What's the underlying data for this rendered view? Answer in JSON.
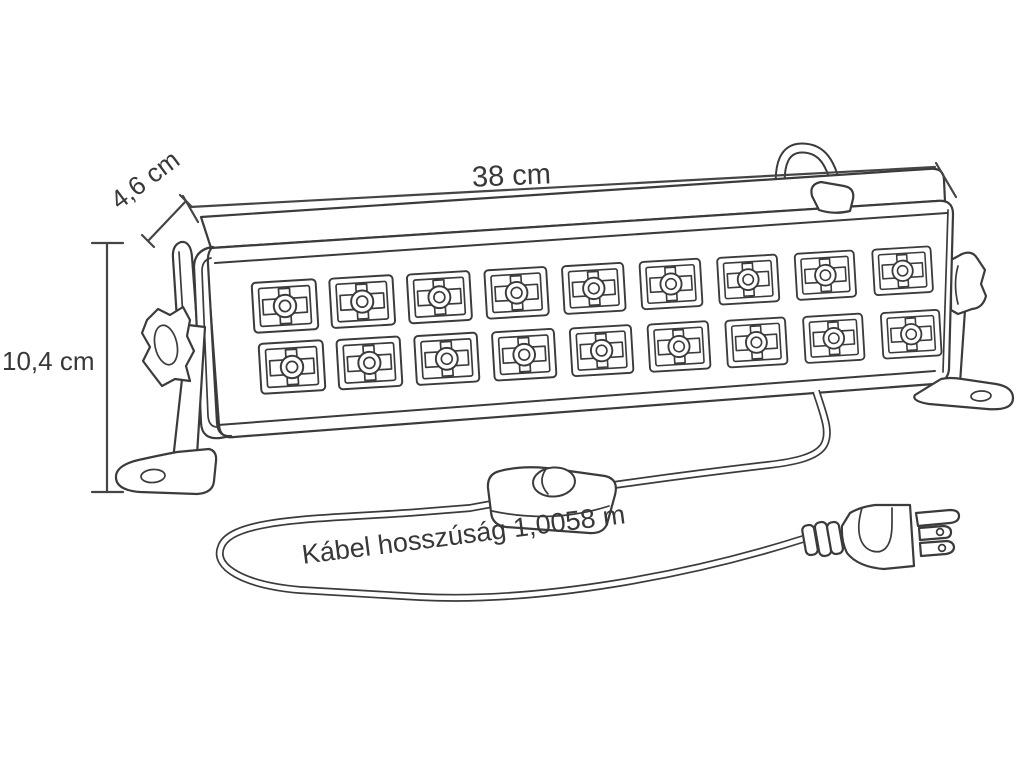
{
  "diagram": {
    "labels": {
      "width": "38 cm",
      "depth": "4,6 cm",
      "height": "10,4 cm",
      "cable_length": "Kábel hosszúság 1,0058 m"
    },
    "fixture": {
      "led_rows": 2,
      "led_columns": 9,
      "led_count": 18
    },
    "colors": {
      "line": "#3b3b3b",
      "text": "#383838",
      "background": "#ffffff"
    }
  }
}
